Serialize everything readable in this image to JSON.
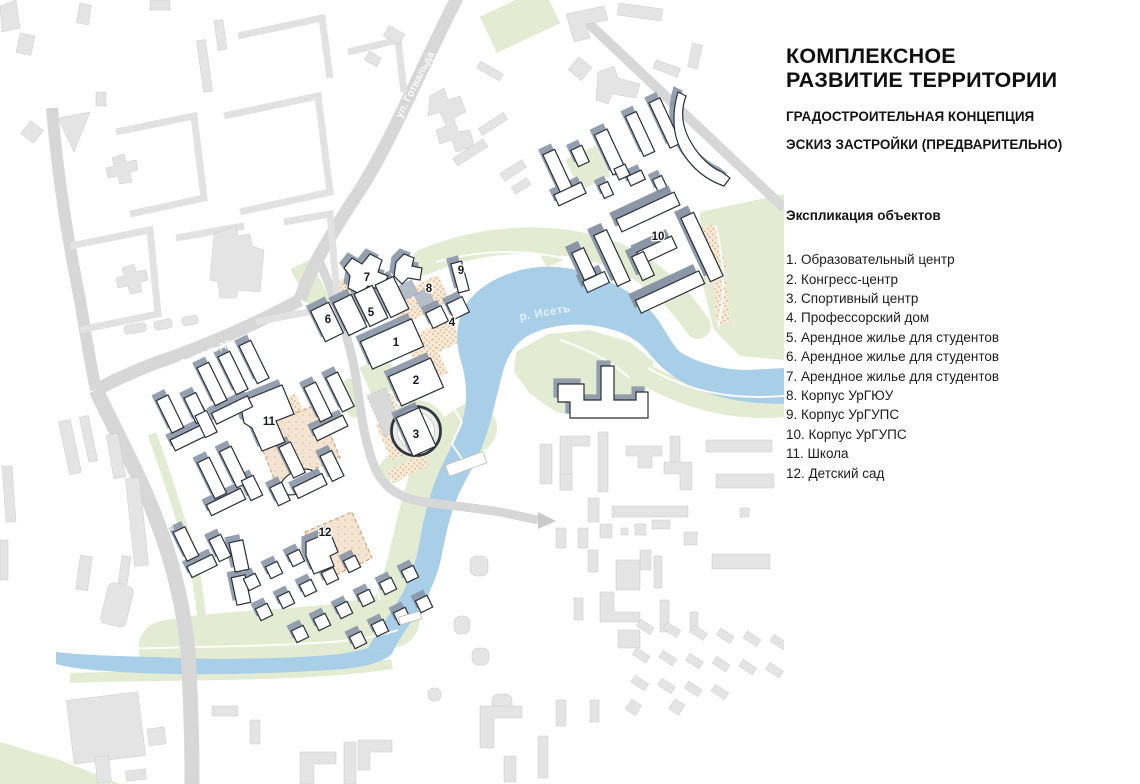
{
  "panel": {
    "title": "КОМПЛЕКСНОЕ РАЗВИТИЕ ТЕРРИТОРИИ",
    "subtitle1": "ГРАДОСТРОИТЕЛЬНАЯ КОНЦЕПЦИЯ",
    "subtitle2": "ЭСКИЗ ЗАСТРОЙКИ (ПРЕДВАРИТЕЛЬНО)",
    "legend_heading": "Экспликация объектов",
    "legend_items": [
      "1. Образовательный центр",
      "2. Конгресс-центр",
      "3. Спортивный центр",
      "4. Профессорский дом",
      "5. Арендное жилье для студентов",
      "6. Арендное жилье для студентов",
      "7. Арендное жилье для студентов",
      "8. Корпус УрГЮУ",
      "9. Корпус УрГУПС",
      "10. Корпус УрГУПС",
      "11. Школа",
      "12. Детский сад"
    ]
  },
  "map": {
    "labels": {
      "street_gotvalda": "ул. Готвальда",
      "street_bebelya": "ул. Бебеля",
      "river": "р. Исеть"
    },
    "markers": [
      "1",
      "2",
      "3",
      "4",
      "5",
      "6",
      "7",
      "8",
      "9",
      "10",
      "11",
      "12"
    ],
    "colors": {
      "river": "#a9cee8",
      "green": "#e3ecd2",
      "road": "#d7d7d7",
      "context_building": "#e4e4e4",
      "new_building_outline": "#2a2f38",
      "building_shadow": "#8b97a8",
      "paving_dots": "#dfa874",
      "yard_fill": "#f4e4d2"
    }
  }
}
